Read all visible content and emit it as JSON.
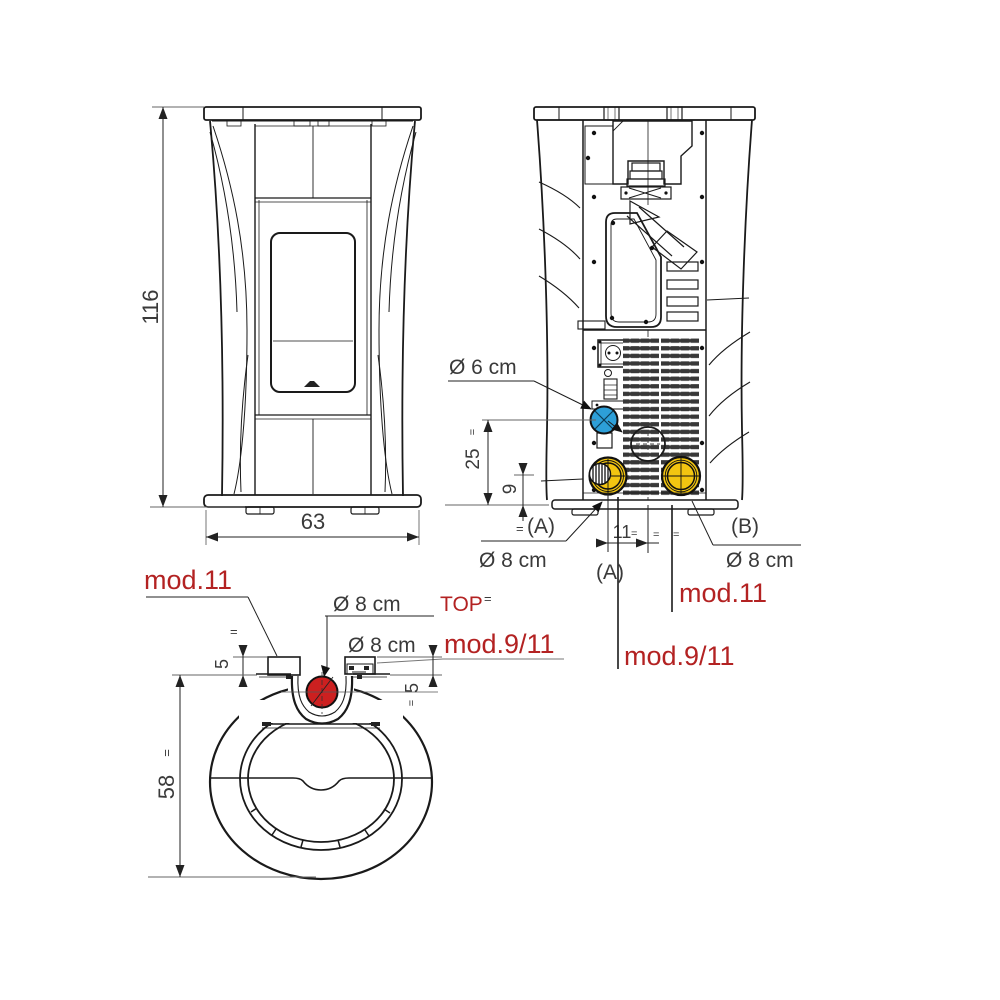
{
  "title": "stove installation dimensions drawing",
  "colors": {
    "line": "#1a1a1a",
    "dim_text": "#3a3a3a",
    "model_red": "#b32222",
    "flue_yellow": "#f2c511",
    "air_blue": "#2d9fd8",
    "top_outlet_red": "#cc2020"
  },
  "marks": {
    "eq": "="
  },
  "front_view": {
    "height": "116",
    "width": "63"
  },
  "back_view": {
    "air_intake": "Ø 6 cm",
    "intake_height": "25",
    "flue_height": "9",
    "label_a": "(A)",
    "outlet_a_diameter": "Ø 8 cm",
    "offset": "11",
    "label_a2": "(A)",
    "label_b": "(B)",
    "outlet_b_diameter": "Ø 8 cm",
    "model_right": "mod.11",
    "model_bottom": "mod.9/11"
  },
  "top_view": {
    "model_left": "mod.11",
    "top_outlet_diameter": "Ø 8 cm",
    "top_outlet_tag": "TOP",
    "rear_outlet_diameter": "Ø 8 cm",
    "model_right": "mod.9/11",
    "block_height_left": "5",
    "block_height_right": "5",
    "depth": "58"
  }
}
